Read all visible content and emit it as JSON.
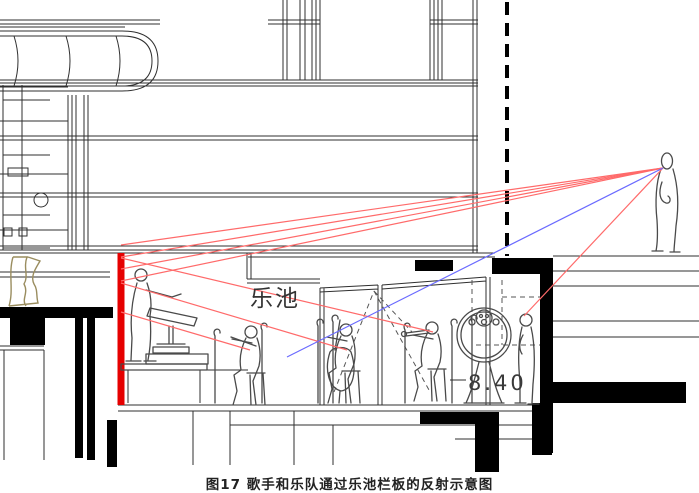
{
  "figure": {
    "caption": "图17 歌手和乐队通过乐池栏板的反射示意图",
    "pit_label": "乐池",
    "level_label": "8.40",
    "colors": {
      "ray_red": "#ff6a6a",
      "ray_blue": "#6a6aff",
      "railing": "#e60000",
      "drawing_line": "#2f2f2f",
      "curtain": "#9a8d5f"
    }
  }
}
